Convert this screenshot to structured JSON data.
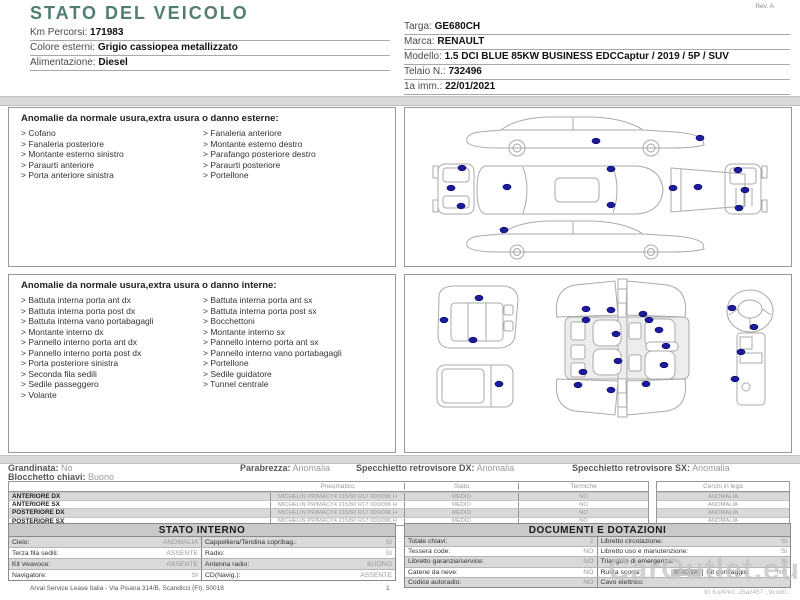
{
  "page": {
    "title": "STATO DEL VEICOLO",
    "rev": "Rev. A"
  },
  "colors": {
    "accent": "#527d72",
    "damage_dot": "#1c1c99",
    "separator": "#d8d8d8",
    "table_header_bg": "#c9c9c9",
    "row_shade": "#d9d9d9"
  },
  "icons": {
    "damage_marker": "navy-ellipse-dot"
  },
  "vehicle_info": {
    "left": [
      {
        "label": "Km Percorsi:",
        "value": "171983"
      },
      {
        "label": "Colore esterni:",
        "value": "Grigio cassiopea metallizzato"
      },
      {
        "label": "Alimentazione:",
        "value": "Diesel"
      }
    ],
    "right": [
      {
        "label": "Targa:",
        "value": "GE680CH"
      },
      {
        "label": "Marca:",
        "value": "RENAULT"
      },
      {
        "label": "Modello:",
        "value": "1.5 DCI BLUE 85KW BUSINESS EDCCaptur / 2019 / 5P / SUV"
      },
      {
        "label": "Telaio N.:",
        "value": "732496"
      },
      {
        "label": "1a imm.:",
        "value": "22/01/2021"
      }
    ]
  },
  "exterior_anomalies": {
    "title": "Anomalie da normale usura,extra usura o danno esterne:",
    "col1": [
      "> Cofano",
      "> Fanaleria posteriore",
      "> Montante esterno sinistro",
      "> Paraurti anteriore",
      "> Porta anteriore sinistra"
    ],
    "col2": [
      "> Fanaleria anteriore",
      "> Montante esterno destro",
      "> Parafango posteriore destro",
      "> Paraurti posteriore",
      "> Portellone"
    ]
  },
  "interior_anomalies": {
    "title": "Anomalie da normale usura,extra usura o danno interne:",
    "col1": [
      "> Battuta interna porta ant dx",
      "> Battuta interna porta post dx",
      "> Battuta interna vano portabagagli",
      "> Montante interno dx",
      "> Pannello interno porta ant dx",
      "> Pannello interno porta post dx",
      "> Porta posteriore sinistra",
      "> Seconda fila sedili",
      "> Sedile passeggero",
      "> Volante"
    ],
    "col2": [
      "> Battuta interna porta ant sx",
      "> Battuta interna porta post sx",
      "> Bocchettoni",
      "> Montante interno sx",
      "> Pannello interno porta ant sx",
      "> Pannello interno vano portabagagli",
      "> Portellone",
      "> Sedile guidatore",
      "> Tunnel centrale"
    ]
  },
  "condition_summary": {
    "items": [
      {
        "label": "Grandinata:",
        "value": "No"
      },
      {
        "label": "Parabrezza:",
        "value": "Anomalia"
      },
      {
        "label": "Specchietto retrovisore DX:",
        "value": "Anomalia"
      },
      {
        "label": "Specchietto retrovisore SX:",
        "value": "Anomalia"
      }
    ],
    "second_row": {
      "label": "Blocchetto chiavi:",
      "value": "Buono"
    }
  },
  "tyres": {
    "header_pneumatico": "Pneumatico",
    "header_stato": "Stato",
    "header_termiche": "Termiche",
    "header_cerchi": "Cerchi in lega",
    "rows": [
      {
        "position": "ANTERIORE DX",
        "tyre": "MICHELIN PRIMACY4 215/60 R17 000/096 H",
        "stato": "MEDIO",
        "termiche": "NO",
        "cerchi": "ANOMALIA"
      },
      {
        "position": "ANTERIORE SX",
        "tyre": "MICHELIN PRIMACY4 215/60 R17 000/096 H",
        "stato": "MEDIO",
        "termiche": "NO",
        "cerchi": "ANOMALIA"
      },
      {
        "position": "POSTERIORE DX",
        "tyre": "MICHELIN PRIMACY4 215/60 R17 000/096 H",
        "stato": "MEDIO",
        "termiche": "NO",
        "cerchi": "ANOMALIA"
      },
      {
        "position": "POSTERIORE SX",
        "tyre": "MICHELIN PRIMACY4 215/60 R17 000/096 H",
        "stato": "MEDIO",
        "termiche": "NO",
        "cerchi": "ANOMALIA"
      }
    ]
  },
  "stato_interno": {
    "title": "STATO INTERNO",
    "rows": [
      {
        "l1": "Cielo:",
        "v1": "ANOMALIA",
        "l2": "Cappelliera/Tendina copribag.:",
        "v2": "SI"
      },
      {
        "l1": "Terza fila sedili:",
        "v1": "ASSENTE",
        "l2": "Radio:",
        "v2": "SI"
      },
      {
        "l1": "Kit vivavoce:",
        "v1": "ASSENTE",
        "l2": "Antenna radio:",
        "v2": "BUONO"
      },
      {
        "l1": "Navigatore:",
        "v1": "SI",
        "l2": "CD(Navig.):",
        "v2": "ASSENTE"
      }
    ]
  },
  "documenti": {
    "title": "DOCUMENTI E DOTAZIONI",
    "rows": [
      {
        "l1": "Totale chiavi:",
        "v1": "2",
        "l2": "Libretto circolazione:",
        "v2": "Si"
      },
      {
        "l1": "Tessera code:",
        "v1": "NO",
        "l2": "Libretto uso e manutenzione:",
        "v2": "Si"
      },
      {
        "l1": "Libretto garanzia/service:",
        "v1": "NO",
        "l2": "Triangolo di emergenza:",
        "v2": "Si"
      },
      {
        "l1": "Catene da neve:",
        "v1": "NO",
        "l2": "Ruota scorta:",
        "v2": "BUONA",
        "l3": "Kit gonfiaggio:",
        "v3": "NO"
      },
      {
        "l1": "Codice autoradio:",
        "v1": "NO",
        "l2": "Cavo elettrico:",
        "v2": ""
      }
    ]
  },
  "footer": {
    "company": "Arval Service Lease Italia - Via Pisana 314/B, Scandicci (FI), 50018",
    "page": "1"
  },
  "watermark": {
    "text": "CarOutlet.eu",
    "code": "ID Ku/lPk0..25az457 ;.9cud0.."
  }
}
